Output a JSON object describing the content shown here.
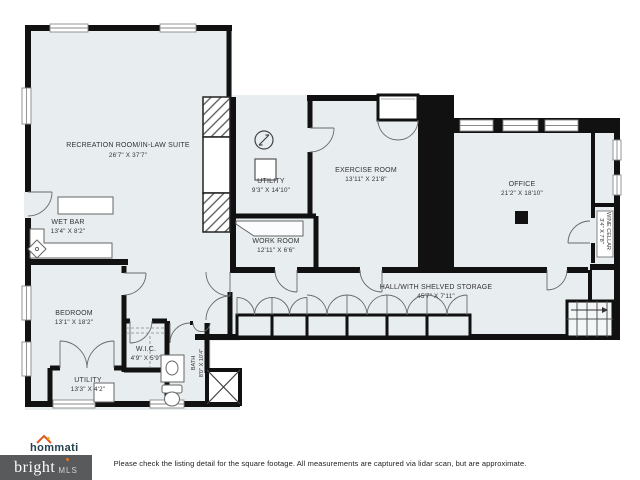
{
  "plan": {
    "rooms": {
      "recreation": {
        "name": "RECREATION ROOM/IN-LAW SUITE",
        "dims": "26'7\" X 37'7\""
      },
      "wet_bar": {
        "name": "WET BAR",
        "dims": "13'4\" X 8'2\""
      },
      "utility_upper": {
        "name": "UTILITY",
        "dims": "9'3\" X 14'10\""
      },
      "exercise": {
        "name": "EXERCISE ROOM",
        "dims": "13'11\" X 21'8\""
      },
      "work": {
        "name": "WORK ROOM",
        "dims": "12'11\" X 6'6\""
      },
      "office": {
        "name": "OFFICE",
        "dims": "21'2\" X 18'10\""
      },
      "wine_cellar": {
        "name": "WINE CELLAR",
        "dims": "3'4\" X 7'8\""
      },
      "hall": {
        "name": "HALL/WITH SHELVED STORAGE",
        "dims": "45'7\" X 7'11\""
      },
      "bedroom": {
        "name": "BEDROOM",
        "dims": "13'1\" X 18'2\""
      },
      "wic": {
        "name": "W.I.C.",
        "dims": "4'9\" X 5'9\""
      },
      "utility_lower": {
        "name": "UTILITY",
        "dims": "13'3\" X 4'2\""
      },
      "bath": {
        "name": "BATH",
        "dims": "8'0\" X 10'4\""
      }
    },
    "colors": {
      "floor": "#e8edf0",
      "wall": "#111111",
      "accent": "#e8731a"
    }
  },
  "footer": {
    "disclaimer": "Please check the listing detail for the square footage. All measurements are captured via lidar scan, but are approximate.",
    "hommati_logo": "hommati",
    "bright_logo": {
      "brand": "bright",
      "suffix": "MLS"
    }
  }
}
